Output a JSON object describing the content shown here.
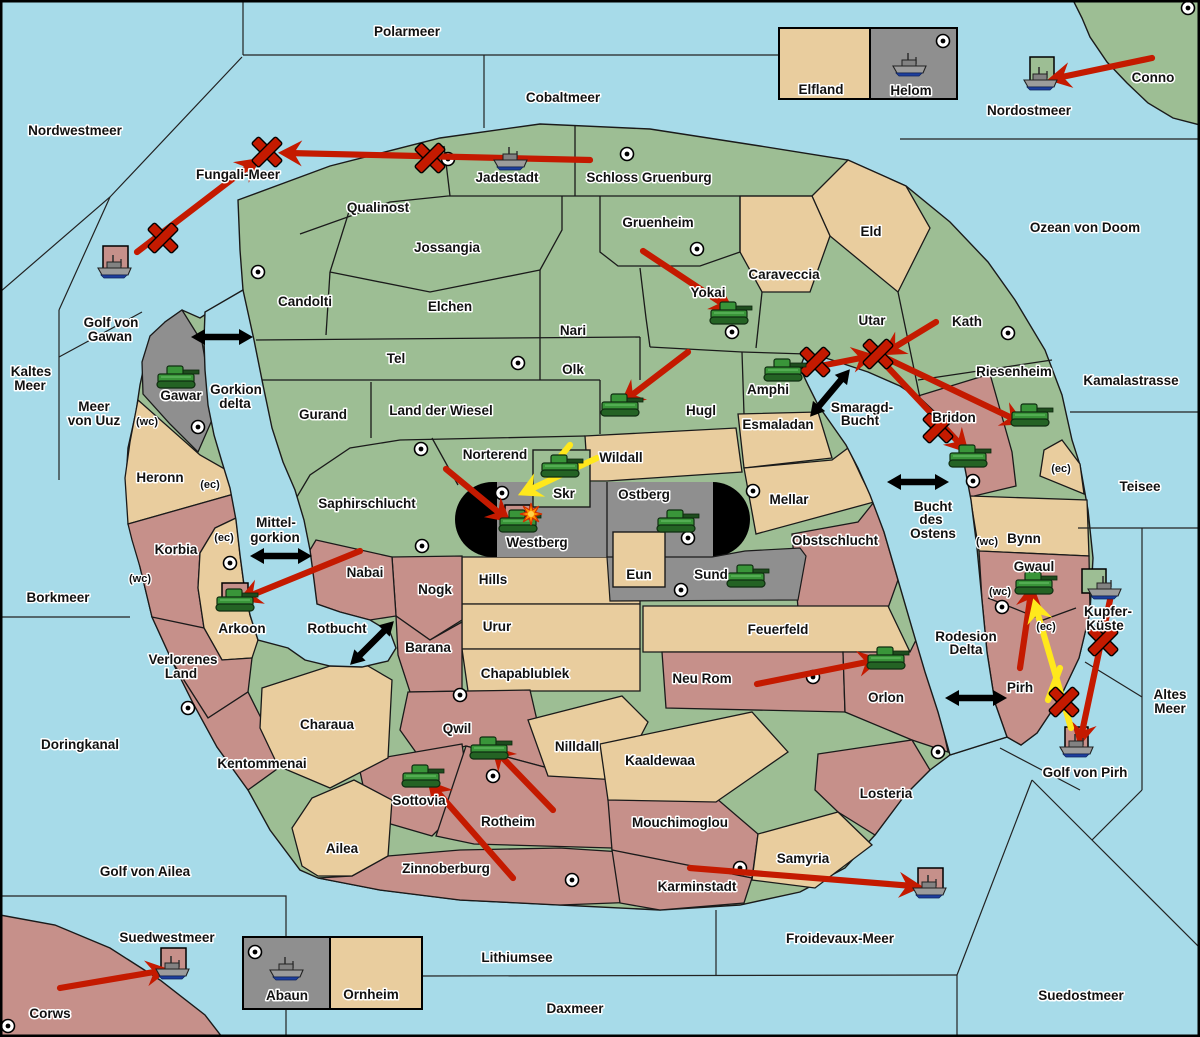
{
  "title": "Strategy war map",
  "colors": {
    "sea": "#A7DBE9",
    "green": "#9DBE94",
    "tan": "#E9CD9E",
    "rose": "#C6908A",
    "gray": "#8F8F8F",
    "black": "#000000",
    "red": "#C41A00",
    "yellow": "#FFE81C",
    "tank": "#399539",
    "ship_hull": "#9C9C9C",
    "ship_keel": "#1D3F9E",
    "border": "#1A1A1A"
  },
  "labels": [
    {
      "t": "Nordwestmeer",
      "x": 75,
      "y": 131,
      "k": "s"
    },
    {
      "t": "Polarmeer",
      "x": 407,
      "y": 32,
      "k": "s"
    },
    {
      "t": "Cobaltmeer",
      "x": 563,
      "y": 98,
      "k": "s"
    },
    {
      "t": "Fungali-Meer",
      "x": 238,
      "y": 175,
      "k": "s"
    },
    {
      "t": "Nordostmeer",
      "x": 1029,
      "y": 111,
      "k": "s"
    },
    {
      "t": "Ozean von Doom",
      "x": 1085,
      "y": 228,
      "k": "s"
    },
    {
      "t": "Golf von",
      "x": 111,
      "y": 323,
      "k": "s"
    },
    {
      "t": "Gawan",
      "x": 110,
      "y": 337,
      "k": "s"
    },
    {
      "t": "Kaltes",
      "x": 31,
      "y": 372,
      "k": "s"
    },
    {
      "t": "Meer",
      "x": 30,
      "y": 386,
      "k": "s"
    },
    {
      "t": "Meer",
      "x": 94,
      "y": 407,
      "k": "s"
    },
    {
      "t": "von Uuz",
      "x": 94,
      "y": 421,
      "k": "s"
    },
    {
      "t": "Kamalastrasse",
      "x": 1131,
      "y": 381,
      "k": "s"
    },
    {
      "t": "Teisee",
      "x": 1140,
      "y": 487,
      "k": "s"
    },
    {
      "t": "Borkmeer",
      "x": 58,
      "y": 598,
      "k": "s"
    },
    {
      "t": "Mittel-",
      "x": 276,
      "y": 523,
      "k": "s"
    },
    {
      "t": "gorkion",
      "x": 275,
      "y": 538,
      "k": "s"
    },
    {
      "t": "Rotbucht",
      "x": 337,
      "y": 629,
      "k": "s"
    },
    {
      "t": "Smaragd-",
      "x": 862,
      "y": 408,
      "k": "s"
    },
    {
      "t": "Bucht",
      "x": 860,
      "y": 421,
      "k": "s"
    },
    {
      "t": "Bucht",
      "x": 933,
      "y": 507,
      "k": "s"
    },
    {
      "t": "des",
      "x": 931,
      "y": 520,
      "k": "s"
    },
    {
      "t": "Ostens",
      "x": 933,
      "y": 534,
      "k": "s"
    },
    {
      "t": "Gorkion",
      "x": 236,
      "y": 390,
      "k": "s"
    },
    {
      "t": "delta",
      "x": 235,
      "y": 404,
      "k": "s"
    },
    {
      "t": "Doringkanal",
      "x": 80,
      "y": 745,
      "k": "s"
    },
    {
      "t": "Golf von Ailea",
      "x": 145,
      "y": 872,
      "k": "s"
    },
    {
      "t": "Suedwestmeer",
      "x": 167,
      "y": 938,
      "k": "s"
    },
    {
      "t": "Lithiumsee",
      "x": 517,
      "y": 958,
      "k": "s"
    },
    {
      "t": "Daxmeer",
      "x": 575,
      "y": 1009,
      "k": "s"
    },
    {
      "t": "Froidevaux-Meer",
      "x": 840,
      "y": 939,
      "k": "s"
    },
    {
      "t": "Suedostmeer",
      "x": 1081,
      "y": 996,
      "k": "s"
    },
    {
      "t": "Golf von Pirh",
      "x": 1085,
      "y": 773,
      "k": "s"
    },
    {
      "t": "Kupfer-",
      "x": 1108,
      "y": 612,
      "k": "s"
    },
    {
      "t": "Küste",
      "x": 1105,
      "y": 626,
      "k": "s"
    },
    {
      "t": "Rodesion",
      "x": 966,
      "y": 637,
      "k": "s"
    },
    {
      "t": "Delta",
      "x": 966,
      "y": 650,
      "k": "s"
    },
    {
      "t": "Altes",
      "x": 1170,
      "y": 695,
      "k": "s"
    },
    {
      "t": "Meer",
      "x": 1170,
      "y": 709,
      "k": "s"
    },
    {
      "t": "Conno",
      "x": 1153,
      "y": 78,
      "k": "r"
    },
    {
      "t": "Corws",
      "x": 50,
      "y": 1014,
      "k": "r"
    },
    {
      "t": "Jadestadt",
      "x": 507,
      "y": 178,
      "k": "r"
    },
    {
      "t": "Schloss Gruenburg",
      "x": 649,
      "y": 178,
      "k": "r"
    },
    {
      "t": "Qualinost",
      "x": 378,
      "y": 208,
      "k": "r"
    },
    {
      "t": "Jossangia",
      "x": 447,
      "y": 248,
      "k": "r"
    },
    {
      "t": "Gruenheim",
      "x": 658,
      "y": 223,
      "k": "r"
    },
    {
      "t": "Eld",
      "x": 871,
      "y": 232,
      "k": "r"
    },
    {
      "t": "Caraveccia",
      "x": 784,
      "y": 275,
      "k": "r"
    },
    {
      "t": "Candolti",
      "x": 305,
      "y": 302,
      "k": "r"
    },
    {
      "t": "Elchen",
      "x": 450,
      "y": 307,
      "k": "r"
    },
    {
      "t": "Nari",
      "x": 573,
      "y": 331,
      "k": "r"
    },
    {
      "t": "Tel",
      "x": 396,
      "y": 359,
      "k": "r"
    },
    {
      "t": "Olk",
      "x": 573,
      "y": 370,
      "k": "r"
    },
    {
      "t": "Yokai",
      "x": 708,
      "y": 293,
      "k": "r"
    },
    {
      "t": "Utar",
      "x": 872,
      "y": 321,
      "k": "r"
    },
    {
      "t": "Kath",
      "x": 967,
      "y": 322,
      "k": "r"
    },
    {
      "t": "Gurand",
      "x": 323,
      "y": 415,
      "k": "r"
    },
    {
      "t": "Land der Wiesel",
      "x": 441,
      "y": 411,
      "k": "r"
    },
    {
      "t": "Hugl",
      "x": 701,
      "y": 411,
      "k": "r"
    },
    {
      "t": "Amphi",
      "x": 768,
      "y": 390,
      "k": "r"
    },
    {
      "t": "Riesenheim",
      "x": 1014,
      "y": 372,
      "k": "r"
    },
    {
      "t": "Esmaladan",
      "x": 778,
      "y": 425,
      "k": "r"
    },
    {
      "t": "Bridon",
      "x": 954,
      "y": 418,
      "k": "r"
    },
    {
      "t": "Norterend",
      "x": 495,
      "y": 455,
      "k": "r"
    },
    {
      "t": "Wildall",
      "x": 621,
      "y": 458,
      "k": "r"
    },
    {
      "t": "Saphirschlucht",
      "x": 367,
      "y": 504,
      "k": "r"
    },
    {
      "t": "Skr",
      "x": 564,
      "y": 494,
      "k": "r"
    },
    {
      "t": "Ostberg",
      "x": 644,
      "y": 495,
      "k": "r"
    },
    {
      "t": "Westberg",
      "x": 537,
      "y": 543,
      "k": "r"
    },
    {
      "t": "Mellar",
      "x": 789,
      "y": 500,
      "k": "r"
    },
    {
      "t": "Obstschlucht",
      "x": 835,
      "y": 541,
      "k": "r"
    },
    {
      "t": "Eun",
      "x": 639,
      "y": 575,
      "k": "r"
    },
    {
      "t": "Sund",
      "x": 711,
      "y": 575,
      "k": "r"
    },
    {
      "t": "Gawar",
      "x": 181,
      "y": 396,
      "k": "r"
    },
    {
      "t": "Heronn",
      "x": 160,
      "y": 478,
      "k": "r"
    },
    {
      "t": "Korbia",
      "x": 176,
      "y": 550,
      "k": "r"
    },
    {
      "t": "Arkoon",
      "x": 242,
      "y": 629,
      "k": "r"
    },
    {
      "t": "Nabai",
      "x": 365,
      "y": 573,
      "k": "r"
    },
    {
      "t": "Nogk",
      "x": 435,
      "y": 590,
      "k": "r"
    },
    {
      "t": "Hills",
      "x": 493,
      "y": 580,
      "k": "r"
    },
    {
      "t": "Urur",
      "x": 497,
      "y": 627,
      "k": "r"
    },
    {
      "t": "Chapablublek",
      "x": 525,
      "y": 674,
      "k": "r"
    },
    {
      "t": "Barana",
      "x": 428,
      "y": 648,
      "k": "r"
    },
    {
      "t": "Verlorenes",
      "x": 183,
      "y": 660,
      "k": "r"
    },
    {
      "t": "Land",
      "x": 181,
      "y": 674,
      "k": "r"
    },
    {
      "t": "Kentommenai",
      "x": 262,
      "y": 764,
      "k": "r"
    },
    {
      "t": "Charaua",
      "x": 327,
      "y": 725,
      "k": "r"
    },
    {
      "t": "Qwil",
      "x": 457,
      "y": 729,
      "k": "r"
    },
    {
      "t": "Nilldall",
      "x": 577,
      "y": 747,
      "k": "r"
    },
    {
      "t": "Neu Rom",
      "x": 702,
      "y": 679,
      "k": "r"
    },
    {
      "t": "Feuerfeld",
      "x": 778,
      "y": 630,
      "k": "r"
    },
    {
      "t": "Orlon",
      "x": 886,
      "y": 698,
      "k": "r"
    },
    {
      "t": "Kaaldewaa",
      "x": 660,
      "y": 761,
      "k": "r"
    },
    {
      "t": "Losteria",
      "x": 886,
      "y": 794,
      "k": "r"
    },
    {
      "t": "Samyria",
      "x": 803,
      "y": 859,
      "k": "r"
    },
    {
      "t": "Mouchimoglou",
      "x": 680,
      "y": 823,
      "k": "r"
    },
    {
      "t": "Karminstadt",
      "x": 697,
      "y": 887,
      "k": "r"
    },
    {
      "t": "Rotheim",
      "x": 508,
      "y": 822,
      "k": "r"
    },
    {
      "t": "Sottovia",
      "x": 419,
      "y": 801,
      "k": "r"
    },
    {
      "t": "Zinnoberburg",
      "x": 446,
      "y": 869,
      "k": "r"
    },
    {
      "t": "Ailea",
      "x": 342,
      "y": 849,
      "k": "r"
    },
    {
      "t": "Bynn",
      "x": 1024,
      "y": 539,
      "k": "r"
    },
    {
      "t": "Gwaul",
      "x": 1034,
      "y": 567,
      "k": "r"
    },
    {
      "t": "Pirh",
      "x": 1020,
      "y": 688,
      "k": "r"
    },
    {
      "t": "Elfland",
      "x": 821,
      "y": 90,
      "k": "r"
    },
    {
      "t": "Helom",
      "x": 911,
      "y": 91,
      "k": "r"
    },
    {
      "t": "Abaun",
      "x": 287,
      "y": 996,
      "k": "r"
    },
    {
      "t": "Ornheim",
      "x": 371,
      "y": 995,
      "k": "r"
    },
    {
      "t": "(wc)",
      "x": 147,
      "y": 421,
      "k": "m"
    },
    {
      "t": "(ec)",
      "x": 210,
      "y": 484,
      "k": "m"
    },
    {
      "t": "(ec)",
      "x": 224,
      "y": 537,
      "k": "m"
    },
    {
      "t": "(wc)",
      "x": 140,
      "y": 578,
      "k": "m"
    },
    {
      "t": "(ec)",
      "x": 1061,
      "y": 468,
      "k": "m"
    },
    {
      "t": "(wc)",
      "x": 987,
      "y": 541,
      "k": "m"
    },
    {
      "t": "(wc)",
      "x": 1000,
      "y": 591,
      "k": "m"
    },
    {
      "t": "(ec)",
      "x": 1046,
      "y": 626,
      "k": "m"
    }
  ],
  "units": {
    "tanks": [
      {
        "x": 176,
        "y": 378
      },
      {
        "x": 729,
        "y": 314
      },
      {
        "x": 783,
        "y": 371
      },
      {
        "x": 620,
        "y": 406
      },
      {
        "x": 560,
        "y": 467
      },
      {
        "x": 518,
        "y": 522
      },
      {
        "x": 676,
        "y": 522
      },
      {
        "x": 746,
        "y": 577
      },
      {
        "x": 1030,
        "y": 416
      },
      {
        "x": 968,
        "y": 457
      },
      {
        "x": 235,
        "y": 601
      },
      {
        "x": 489,
        "y": 749
      },
      {
        "x": 421,
        "y": 777
      },
      {
        "x": 886,
        "y": 659
      },
      {
        "x": 1034,
        "y": 584
      }
    ],
    "ships": [
      {
        "x": 511,
        "y": 160
      },
      {
        "x": 115,
        "y": 268
      },
      {
        "x": 910,
        "y": 66
      },
      {
        "x": 1041,
        "y": 80
      },
      {
        "x": 1105,
        "y": 589
      },
      {
        "x": 1077,
        "y": 747
      },
      {
        "x": 173,
        "y": 969
      },
      {
        "x": 930,
        "y": 888
      },
      {
        "x": 287,
        "y": 970
      }
    ]
  },
  "markers": {
    "crosses": [
      {
        "x": 267,
        "y": 152
      },
      {
        "x": 430,
        "y": 158
      },
      {
        "x": 163,
        "y": 238
      },
      {
        "x": 815,
        "y": 362
      },
      {
        "x": 878,
        "y": 354
      },
      {
        "x": 938,
        "y": 428
      },
      {
        "x": 1103,
        "y": 641
      },
      {
        "x": 1064,
        "y": 702
      }
    ],
    "explosions": [
      {
        "x": 531,
        "y": 514
      }
    ],
    "dots": [
      {
        "x": 448,
        "y": 159
      },
      {
        "x": 627,
        "y": 154
      },
      {
        "x": 697,
        "y": 249
      },
      {
        "x": 1188,
        "y": 8
      },
      {
        "x": 943,
        "y": 41
      },
      {
        "x": 258,
        "y": 272
      },
      {
        "x": 518,
        "y": 363
      },
      {
        "x": 421,
        "y": 449
      },
      {
        "x": 732,
        "y": 332
      },
      {
        "x": 753,
        "y": 491
      },
      {
        "x": 1008,
        "y": 333
      },
      {
        "x": 973,
        "y": 481
      },
      {
        "x": 198,
        "y": 427
      },
      {
        "x": 230,
        "y": 563
      },
      {
        "x": 188,
        "y": 708
      },
      {
        "x": 422,
        "y": 546
      },
      {
        "x": 460,
        "y": 695
      },
      {
        "x": 502,
        "y": 493
      },
      {
        "x": 688,
        "y": 538
      },
      {
        "x": 681,
        "y": 590
      },
      {
        "x": 813,
        "y": 677
      },
      {
        "x": 938,
        "y": 752
      },
      {
        "x": 493,
        "y": 776
      },
      {
        "x": 572,
        "y": 880
      },
      {
        "x": 740,
        "y": 868
      },
      {
        "x": 8,
        "y": 1026
      },
      {
        "x": 255,
        "y": 952
      },
      {
        "x": 1002,
        "y": 607
      }
    ],
    "squares": [
      {
        "x": 1030,
        "y": 57,
        "s": 24,
        "c": "green"
      },
      {
        "x": 1082,
        "y": 569,
        "s": 24,
        "c": "green"
      },
      {
        "x": 1065,
        "y": 727,
        "s": 23,
        "c": "rose"
      },
      {
        "x": 161,
        "y": 948,
        "s": 25,
        "c": "rose"
      },
      {
        "x": 918,
        "y": 868,
        "s": 25,
        "c": "rose"
      },
      {
        "x": 222,
        "y": 583,
        "s": 26,
        "c": "rose"
      },
      {
        "x": 505,
        "y": 505,
        "s": 25,
        "c": "rose"
      },
      {
        "x": 103,
        "y": 246,
        "s": 25,
        "c": "rose"
      }
    ],
    "strait_arrows": [
      {
        "x": 222,
        "y": 337,
        "a": 0
      },
      {
        "x": 281,
        "y": 556,
        "a": 0
      },
      {
        "x": 372,
        "y": 643,
        "a": -45
      },
      {
        "x": 830,
        "y": 393,
        "a": -50
      },
      {
        "x": 918,
        "y": 482,
        "a": 0
      },
      {
        "x": 976,
        "y": 698,
        "a": 0
      }
    ]
  },
  "attack_arrows": [
    {
      "c": "red",
      "x1": 590,
      "y1": 160,
      "x2": 288,
      "y2": 153
    },
    {
      "c": "red",
      "x1": 137,
      "y1": 252,
      "x2": 252,
      "y2": 164
    },
    {
      "c": "red",
      "x1": 1152,
      "y1": 58,
      "x2": 1057,
      "y2": 78
    },
    {
      "c": "red",
      "x1": 643,
      "y1": 251,
      "x2": 726,
      "y2": 306
    },
    {
      "c": "red",
      "x1": 688,
      "y1": 352,
      "x2": 628,
      "y2": 398
    },
    {
      "c": "red",
      "x1": 800,
      "y1": 370,
      "x2": 866,
      "y2": 357
    },
    {
      "c": "red",
      "x1": 884,
      "y1": 357,
      "x2": 1016,
      "y2": 420
    },
    {
      "c": "red",
      "x1": 881,
      "y1": 360,
      "x2": 962,
      "y2": 446
    },
    {
      "c": "red",
      "x1": 936,
      "y1": 322,
      "x2": 890,
      "y2": 350
    },
    {
      "c": "red",
      "x1": 360,
      "y1": 551,
      "x2": 247,
      "y2": 597
    },
    {
      "c": "red",
      "x1": 757,
      "y1": 684,
      "x2": 872,
      "y2": 661
    },
    {
      "c": "red",
      "x1": 553,
      "y1": 810,
      "x2": 498,
      "y2": 753
    },
    {
      "c": "red",
      "x1": 513,
      "y1": 878,
      "x2": 434,
      "y2": 788
    },
    {
      "c": "red",
      "x1": 690,
      "y1": 868,
      "x2": 913,
      "y2": 886
    },
    {
      "c": "red",
      "x1": 60,
      "y1": 988,
      "x2": 160,
      "y2": 971
    },
    {
      "c": "red",
      "x1": 1020,
      "y1": 668,
      "x2": 1031,
      "y2": 593
    },
    {
      "c": "red",
      "x1": 1110,
      "y1": 600,
      "x2": 1081,
      "y2": 737
    },
    {
      "c": "red",
      "x1": 446,
      "y1": 469,
      "x2": 503,
      "y2": 516
    },
    {
      "c": "yellow",
      "x1": 597,
      "y1": 458,
      "x2": 527,
      "y2": 491
    },
    {
      "c": "yellow",
      "x1": 570,
      "y1": 445,
      "x2": 545,
      "y2": 475,
      "nohead": true
    },
    {
      "c": "yellow",
      "x1": 1071,
      "y1": 728,
      "x2": 1036,
      "y2": 608
    },
    {
      "c": "yellow",
      "x1": 1048,
      "y1": 700,
      "x2": 1060,
      "y2": 668,
      "nohead": true
    }
  ],
  "legend_boxes": [
    {
      "x": 779,
      "y": 28,
      "w": 178,
      "h": 71,
      "cells": [
        {
          "w": 91,
          "c": "tan",
          "label": "Elfland"
        },
        {
          "w": 87,
          "c": "gray",
          "label": "Helom"
        }
      ]
    },
    {
      "x": 243,
      "y": 937,
      "w": 179,
      "h": 72,
      "cells": [
        {
          "w": 87,
          "c": "gray",
          "label": "Abaun"
        },
        {
          "w": 92,
          "c": "tan",
          "label": "Ornheim"
        }
      ]
    }
  ]
}
